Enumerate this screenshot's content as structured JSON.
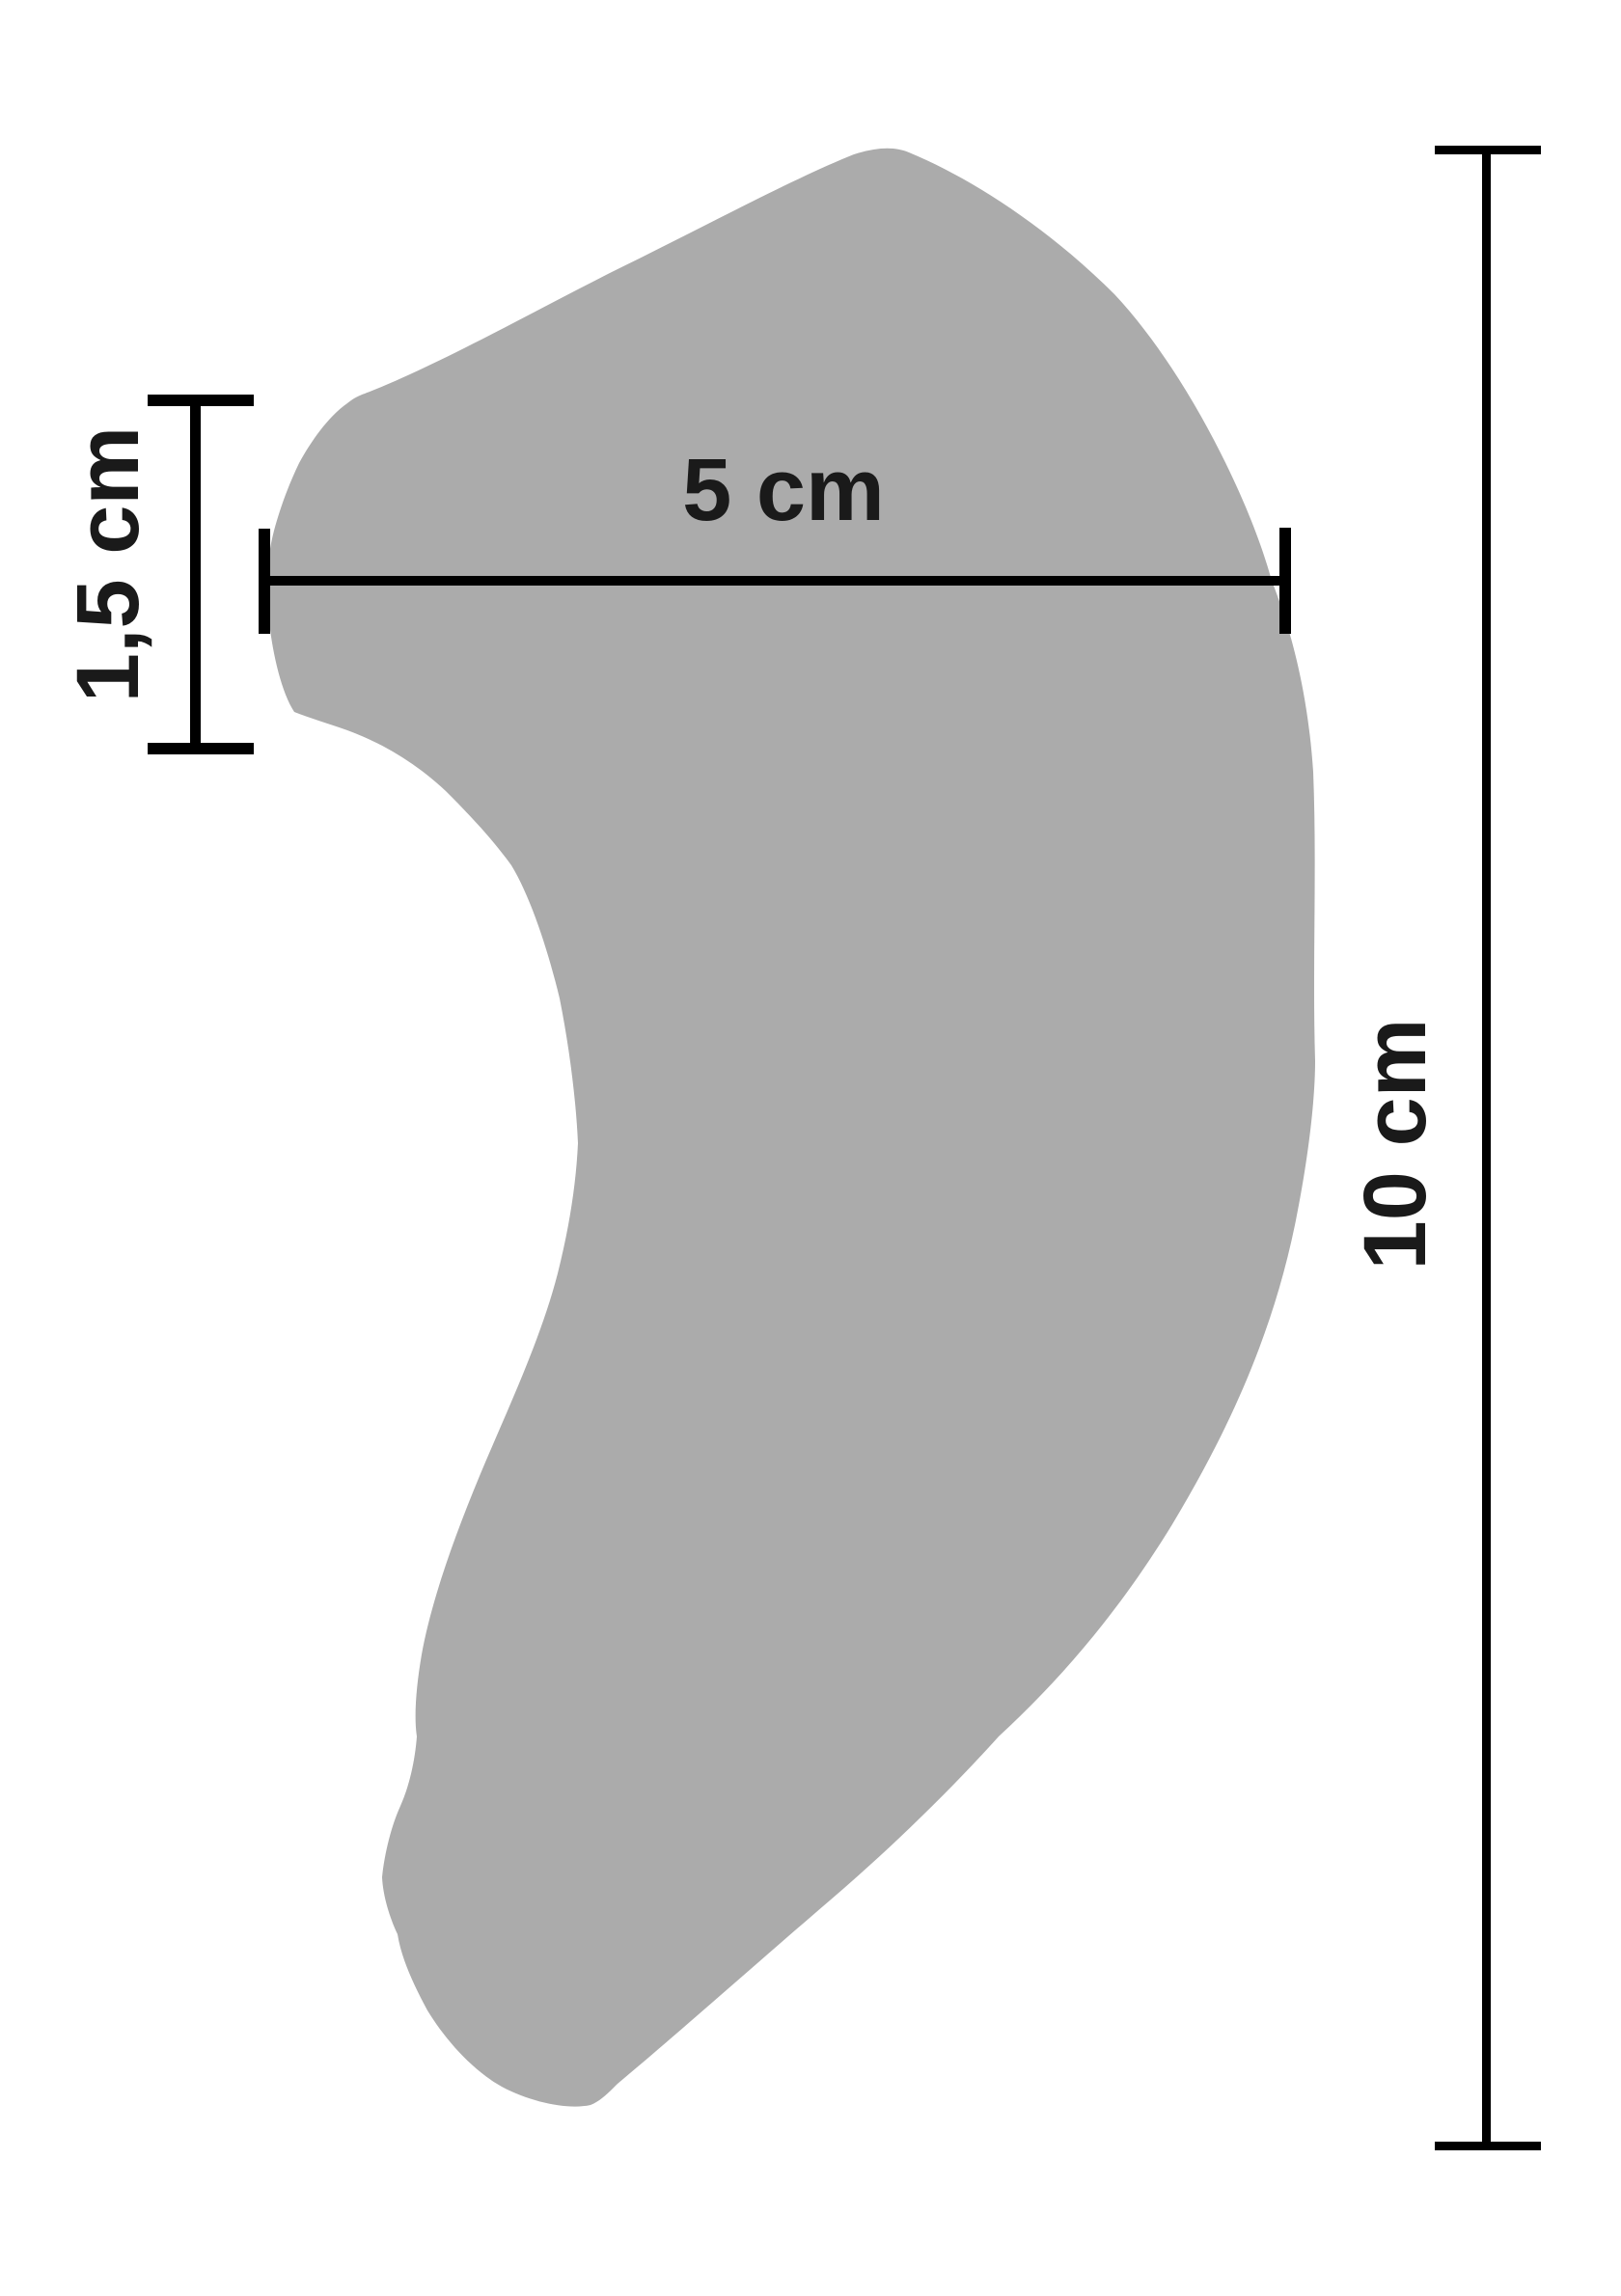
{
  "figure": {
    "title": "shape-with-dimensions",
    "colors": {
      "shape_fill": "#ababab",
      "dimension_line": "#000000",
      "label_text": "#1a1a1a",
      "background": "#ffffff"
    },
    "dimensions": {
      "width_label": {
        "text": "5 cm"
      },
      "height_label": {
        "text": "10 cm"
      },
      "thickness_label": {
        "text": "1,5 cm"
      }
    }
  }
}
